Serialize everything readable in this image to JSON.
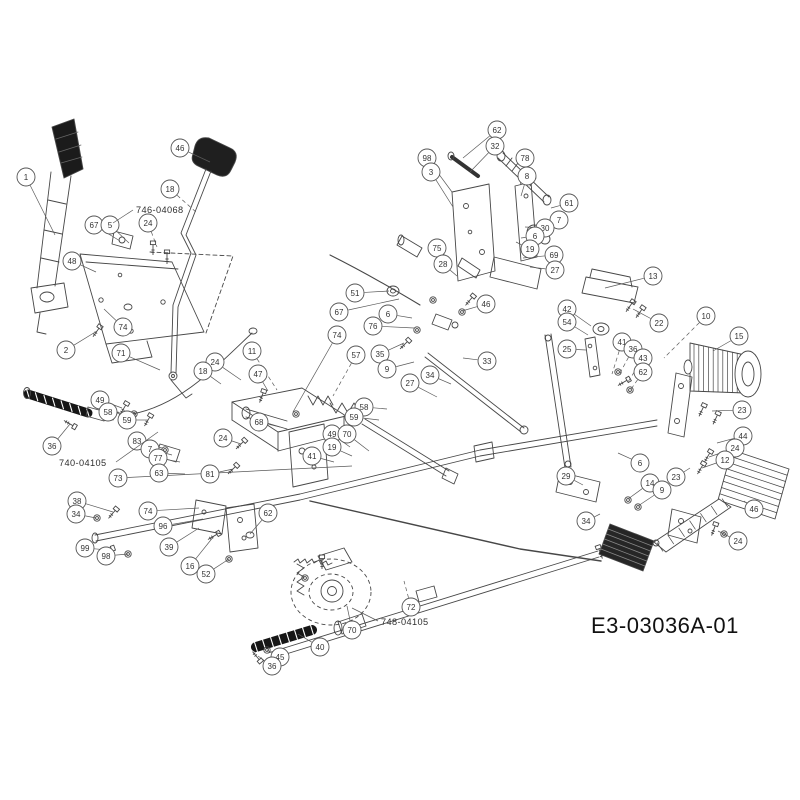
{
  "diagram": {
    "drawing_number": "E3-03036A-01",
    "highlight": {
      "fill": "#f3e15e",
      "stroke": "#c8ab2d",
      "text": "#8a7200"
    },
    "part_labels": [
      {
        "text": "746-04068",
        "x": 136,
        "y": 213,
        "lx1": 133,
        "ly1": 210,
        "lx2": 113,
        "ly2": 223
      },
      {
        "text": "740-04105",
        "x": 59,
        "y": 466,
        "lx1": 116,
        "ly1": 462,
        "lx2": 158,
        "ly2": 432
      },
      {
        "text": "748-04105",
        "x": 381,
        "y": 625,
        "lx1": 378,
        "ly1": 621,
        "lx2": 352,
        "ly2": 608
      }
    ],
    "callouts": [
      {
        "n": "1",
        "x": 26,
        "y": 177,
        "tx": 55,
        "ty": 235
      },
      {
        "n": "46",
        "x": 180,
        "y": 148,
        "tx": 210,
        "ty": 162
      },
      {
        "n": "18",
        "x": 170,
        "y": 189,
        "tx": 196,
        "ty": 212,
        "d": true
      },
      {
        "n": "67",
        "x": 94,
        "y": 225,
        "tx": 120,
        "ty": 241
      },
      {
        "n": "5",
        "x": 110,
        "y": 225,
        "tx": 129,
        "ty": 243
      },
      {
        "n": "24",
        "x": 148,
        "y": 223,
        "tx": 157,
        "ty": 247,
        "d": true
      },
      {
        "n": "48",
        "x": 72,
        "y": 261,
        "tx": 96,
        "ty": 272
      },
      {
        "n": "74",
        "x": 123,
        "y": 327,
        "tx": 104,
        "ty": 309
      },
      {
        "n": "2",
        "x": 66,
        "y": 350,
        "tx": 97,
        "ty": 331
      },
      {
        "n": "71",
        "x": 121,
        "y": 353,
        "tx": 160,
        "ty": 370
      },
      {
        "n": "36",
        "x": 52,
        "y": 446,
        "tx": 70,
        "ty": 424
      },
      {
        "n": "49",
        "x": 100,
        "y": 400,
        "tx": 122,
        "ty": 408
      },
      {
        "n": "58",
        "x": 108,
        "y": 412,
        "tx": 133,
        "ty": 414
      },
      {
        "n": "59",
        "x": 127,
        "y": 420,
        "tx": 148,
        "ty": 420
      },
      {
        "n": "83",
        "x": 137,
        "y": 441,
        "tx": 162,
        "ty": 448
      },
      {
        "n": "7",
        "x": 150,
        "y": 449,
        "tx": 172,
        "ty": 455
      },
      {
        "n": "77",
        "x": 158,
        "y": 458,
        "tx": 180,
        "ty": 462
      },
      {
        "n": "63",
        "x": 159,
        "y": 473,
        "tx": 185,
        "ty": 474
      },
      {
        "n": "73",
        "x": 118,
        "y": 478,
        "tx": 352,
        "ty": 466
      },
      {
        "n": "38",
        "x": 77,
        "y": 501,
        "tx": 113,
        "ty": 512
      },
      {
        "n": "34",
        "x": 76,
        "y": 514,
        "tx": 96,
        "ty": 518
      },
      {
        "n": "99",
        "x": 85,
        "y": 548,
        "tx": 108,
        "ty": 550
      },
      {
        "n": "98",
        "x": 106,
        "y": 556,
        "tx": 128,
        "ty": 554
      },
      {
        "n": "74",
        "x": 148,
        "y": 511,
        "tx": 199,
        "ty": 508
      },
      {
        "n": "96",
        "x": 163,
        "y": 526,
        "tx": 203,
        "ty": 519
      },
      {
        "n": "39",
        "x": 169,
        "y": 547,
        "tx": 199,
        "ty": 528
      },
      {
        "n": "16",
        "x": 190,
        "y": 566,
        "tx": 214,
        "ty": 536
      },
      {
        "n": "52",
        "x": 206,
        "y": 574,
        "tx": 229,
        "ty": 559,
        "h": true
      },
      {
        "n": "62",
        "x": 268,
        "y": 513,
        "tx": 250,
        "ty": 534
      },
      {
        "n": "81",
        "x": 210,
        "y": 474,
        "tx": 233,
        "ty": 469
      },
      {
        "n": "24",
        "x": 223,
        "y": 438,
        "tx": 241,
        "ty": 444
      },
      {
        "n": "11",
        "x": 252,
        "y": 351,
        "tx": 277,
        "ty": 390,
        "d": true
      },
      {
        "n": "74",
        "x": 337,
        "y": 335,
        "tx": 293,
        "ty": 412
      },
      {
        "n": "57",
        "x": 356,
        "y": 355,
        "tx": 333,
        "ty": 396,
        "d": true
      },
      {
        "n": "24",
        "x": 215,
        "y": 362,
        "tx": 241,
        "ty": 380
      },
      {
        "n": "47",
        "x": 258,
        "y": 374,
        "tx": 268,
        "ty": 391
      },
      {
        "n": "18",
        "x": 203,
        "y": 371,
        "tx": 221,
        "ty": 384
      },
      {
        "n": "68",
        "x": 259,
        "y": 422,
        "tx": 280,
        "ty": 427
      },
      {
        "n": "51",
        "x": 355,
        "y": 293,
        "tx": 389,
        "ty": 291
      },
      {
        "n": "67",
        "x": 339,
        "y": 312,
        "tx": 399,
        "ty": 299
      },
      {
        "n": "6",
        "x": 388,
        "y": 314,
        "tx": 412,
        "ty": 318
      },
      {
        "n": "76",
        "x": 373,
        "y": 326,
        "tx": 414,
        "ty": 328
      },
      {
        "n": "35",
        "x": 380,
        "y": 354,
        "tx": 404,
        "ty": 343
      },
      {
        "n": "9",
        "x": 387,
        "y": 369,
        "tx": 414,
        "ty": 362
      },
      {
        "n": "27",
        "x": 410,
        "y": 383,
        "tx": 437,
        "ty": 397
      },
      {
        "n": "34",
        "x": 430,
        "y": 375,
        "tx": 451,
        "ty": 384
      },
      {
        "n": "75",
        "x": 437,
        "y": 248,
        "tx": 452,
        "ty": 262
      },
      {
        "n": "28",
        "x": 443,
        "y": 264,
        "tx": 457,
        "ty": 276
      },
      {
        "n": "46",
        "x": 486,
        "y": 304,
        "tx": 462,
        "ty": 311
      },
      {
        "n": "33",
        "x": 487,
        "y": 361,
        "tx": 463,
        "ty": 358
      },
      {
        "n": "58",
        "x": 364,
        "y": 407,
        "tx": 387,
        "ty": 409
      },
      {
        "n": "59",
        "x": 354,
        "y": 417,
        "tx": 379,
        "ty": 420
      },
      {
        "n": "49",
        "x": 332,
        "y": 434,
        "tx": 350,
        "ty": 447
      },
      {
        "n": "70",
        "x": 347,
        "y": 434,
        "tx": 369,
        "ty": 451
      },
      {
        "n": "19",
        "x": 332,
        "y": 447,
        "tx": 352,
        "ty": 456
      },
      {
        "n": "41",
        "x": 312,
        "y": 456,
        "tx": 334,
        "ty": 462
      },
      {
        "n": "62",
        "x": 497,
        "y": 130,
        "tx": 463,
        "ty": 158
      },
      {
        "n": "32",
        "x": 495,
        "y": 146,
        "tx": 470,
        "ty": 172
      },
      {
        "n": "98",
        "x": 427,
        "y": 158,
        "tx": 452,
        "ty": 192
      },
      {
        "n": "3",
        "x": 431,
        "y": 172,
        "tx": 453,
        "ty": 207
      },
      {
        "n": "78",
        "x": 525,
        "y": 158,
        "tx": 520,
        "ty": 186,
        "d": true
      },
      {
        "n": "8",
        "x": 527,
        "y": 176,
        "tx": 521,
        "ty": 196
      },
      {
        "n": "61",
        "x": 569,
        "y": 203,
        "tx": 551,
        "ty": 208
      },
      {
        "n": "7",
        "x": 559,
        "y": 220,
        "tx": 542,
        "ty": 222
      },
      {
        "n": "30",
        "x": 545,
        "y": 228,
        "tx": 525,
        "ty": 227
      },
      {
        "n": "6",
        "x": 535,
        "y": 236,
        "tx": 521,
        "ty": 238
      },
      {
        "n": "19",
        "x": 530,
        "y": 249,
        "tx": 516,
        "ty": 242
      },
      {
        "n": "69",
        "x": 554,
        "y": 255,
        "tx": 523,
        "ty": 258
      },
      {
        "n": "27",
        "x": 555,
        "y": 270,
        "tx": 530,
        "ty": 267
      },
      {
        "n": "13",
        "x": 653,
        "y": 276,
        "tx": 605,
        "ty": 288
      },
      {
        "n": "22",
        "x": 659,
        "y": 323,
        "tx": 633,
        "ty": 309
      },
      {
        "n": "42",
        "x": 567,
        "y": 309,
        "tx": 591,
        "ty": 326
      },
      {
        "n": "54",
        "x": 567,
        "y": 322,
        "tx": 588,
        "ty": 335
      },
      {
        "n": "25",
        "x": 567,
        "y": 349,
        "tx": 586,
        "ty": 350
      },
      {
        "n": "10",
        "x": 706,
        "y": 316,
        "tx": 664,
        "ty": 358,
        "d": true
      },
      {
        "n": "15",
        "x": 739,
        "y": 336,
        "tx": 713,
        "ty": 351
      },
      {
        "n": "23",
        "x": 742,
        "y": 410,
        "tx": 712,
        "ty": 411
      },
      {
        "n": "41",
        "x": 622,
        "y": 342,
        "tx": 612,
        "ty": 374,
        "d": true
      },
      {
        "n": "36",
        "x": 633,
        "y": 349,
        "tx": 620,
        "ty": 373,
        "d": true
      },
      {
        "n": "43",
        "x": 643,
        "y": 358,
        "tx": 628,
        "ty": 382,
        "d": true
      },
      {
        "n": "62",
        "x": 643,
        "y": 372,
        "tx": 629,
        "ty": 392,
        "d": true
      },
      {
        "n": "44",
        "x": 743,
        "y": 436,
        "tx": 717,
        "ty": 443
      },
      {
        "n": "29",
        "x": 566,
        "y": 476,
        "tx": 583,
        "ty": 485
      },
      {
        "n": "34",
        "x": 586,
        "y": 521,
        "tx": 600,
        "ty": 514
      },
      {
        "n": "24",
        "x": 735,
        "y": 448,
        "tx": 709,
        "ty": 457
      },
      {
        "n": "12",
        "x": 725,
        "y": 460,
        "tx": 702,
        "ty": 468
      },
      {
        "n": "6",
        "x": 640,
        "y": 463,
        "tx": 618,
        "ty": 453
      },
      {
        "n": "23",
        "x": 676,
        "y": 477,
        "tx": 690,
        "ty": 468
      },
      {
        "n": "14",
        "x": 650,
        "y": 483,
        "tx": 628,
        "ty": 499
      },
      {
        "n": "9",
        "x": 662,
        "y": 490,
        "tx": 638,
        "ty": 506
      },
      {
        "n": "46",
        "x": 754,
        "y": 509,
        "tx": 744,
        "ty": 501
      },
      {
        "n": "24",
        "x": 738,
        "y": 541,
        "tx": 718,
        "ty": 531
      },
      {
        "n": "72",
        "x": 411,
        "y": 607,
        "tx": 404,
        "ty": 581,
        "d": true
      },
      {
        "n": "70",
        "x": 352,
        "y": 630,
        "tx": 347,
        "ty": 606
      },
      {
        "n": "40",
        "x": 320,
        "y": 647,
        "tx": 298,
        "ty": 634
      },
      {
        "n": "45",
        "x": 280,
        "y": 657,
        "tx": 267,
        "ty": 650
      },
      {
        "n": "36",
        "x": 272,
        "y": 666,
        "tx": 258,
        "ty": 656
      }
    ]
  }
}
